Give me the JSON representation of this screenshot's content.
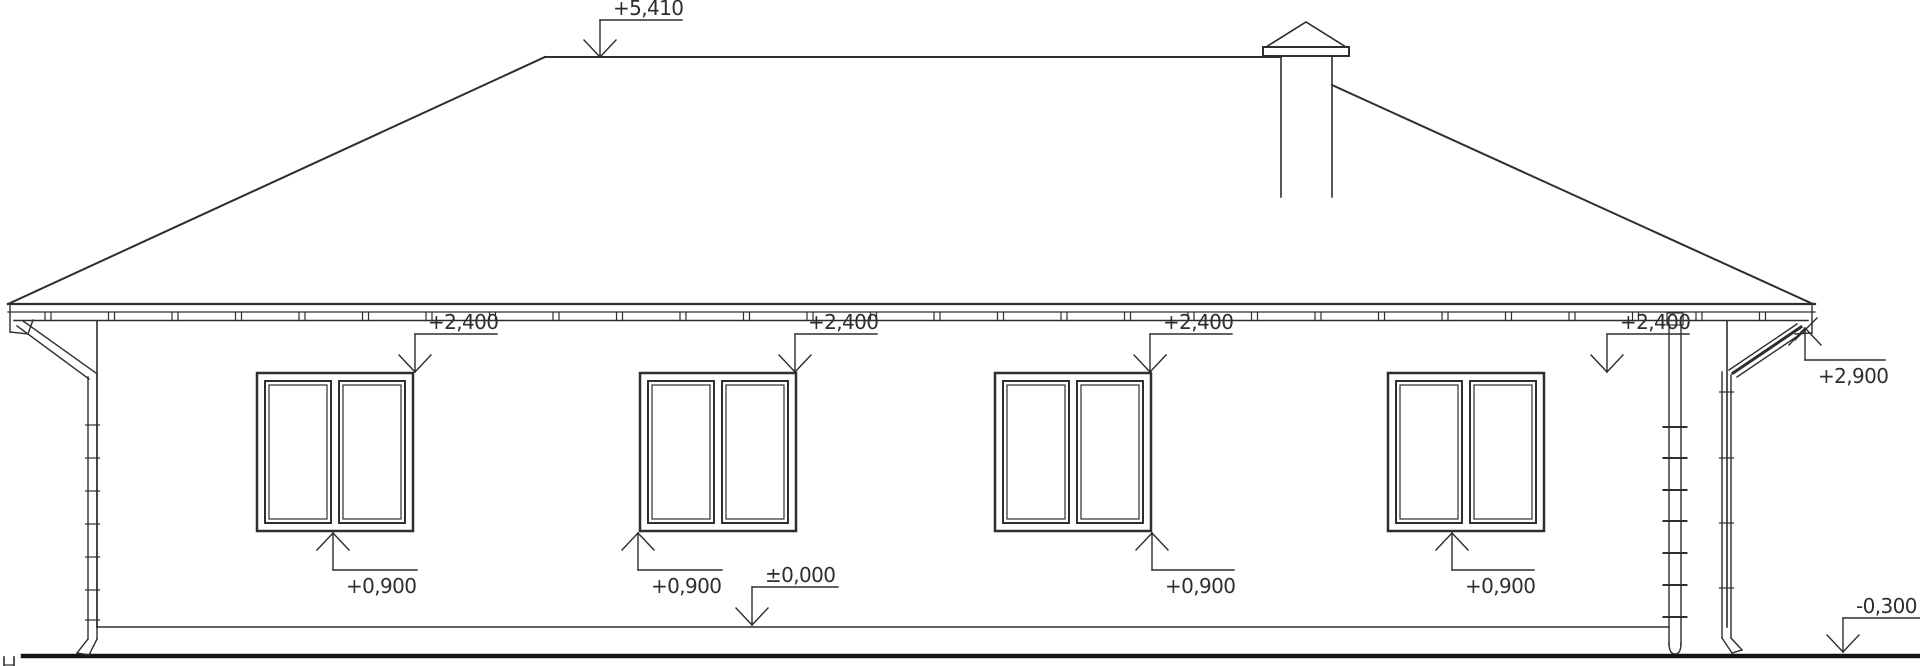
{
  "drawing": {
    "type": "house-elevation-technical-drawing",
    "background_color": "#ffffff",
    "line_color": "#2e2e2e",
    "text_color": "#2e2e2e",
    "grade_line_color": "#141414"
  },
  "elevation_marks": [
    {
      "label": "+5,410",
      "dir": "down",
      "tx": 600,
      "ty": 57,
      "ly": 20,
      "len": 82
    },
    {
      "label": "+2,400",
      "dir": "down",
      "tx": 415,
      "ty": 372,
      "ly": 334,
      "len": 82
    },
    {
      "label": "+2,400",
      "dir": "down",
      "tx": 795,
      "ty": 372,
      "ly": 334,
      "len": 82
    },
    {
      "label": "+2,400",
      "dir": "down",
      "tx": 1150,
      "ty": 372,
      "ly": 334,
      "len": 82
    },
    {
      "label": "+2,400",
      "dir": "down",
      "tx": 1607,
      "ty": 372,
      "ly": 334,
      "len": 82
    },
    {
      "label": "+2,900",
      "dir": "up",
      "tx": 1805,
      "ty": 328,
      "ly": 360,
      "len": 80
    },
    {
      "label": "+0,900",
      "dir": "up",
      "tx": 333,
      "ty": 533,
      "ly": 570,
      "len": 84
    },
    {
      "label": "+0,900",
      "dir": "up",
      "tx": 638,
      "ty": 533,
      "ly": 570,
      "len": 84
    },
    {
      "label": "+0,900",
      "dir": "up",
      "tx": 1152,
      "ty": 533,
      "ly": 570,
      "len": 82
    },
    {
      "label": "+0,900",
      "dir": "up",
      "tx": 1452,
      "ty": 533,
      "ly": 570,
      "len": 82
    },
    {
      "label": "±0,000",
      "dir": "down",
      "tx": 752,
      "ty": 625,
      "ly": 587,
      "len": 86
    },
    {
      "label": "-0,300",
      "dir": "down",
      "tx": 1843,
      "ty": 652,
      "ly": 618,
      "len": 77
    }
  ],
  "windows": {
    "count": 4,
    "x_positions": [
      257,
      640,
      995,
      1388
    ],
    "y": 373,
    "width": 156,
    "height": 158,
    "sashes_per_window": 2
  },
  "gutter": {
    "tick_start_x": 45,
    "tick_end_x": 1765,
    "tick_step": 63.5
  }
}
